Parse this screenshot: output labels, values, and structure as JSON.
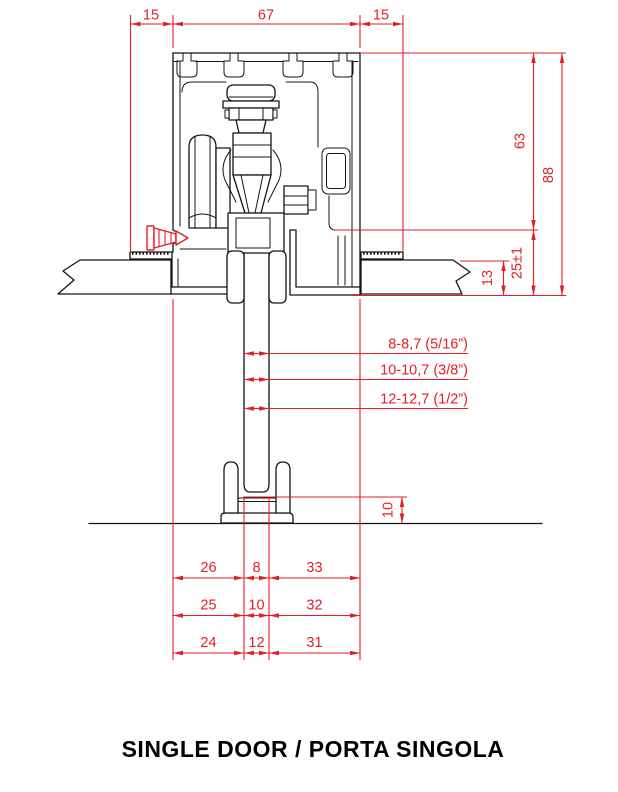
{
  "title": "SINGLE DOOR / PORTA SINGOLA",
  "colors": {
    "dimension_red": "#e31e24",
    "drawing_black": "#141414"
  },
  "dims": {
    "top_left_offset": "15",
    "top_track_width": "67",
    "top_right_offset": "15",
    "right_track_to_glass_top": "63",
    "right_total_height": "88",
    "right_glass_to_ceiling": "25±1",
    "right_ceiling_thickness": "13",
    "glass_rows": [
      "8-8,7 (5/16”)",
      "10-10,7 (3/8”)",
      "12-12,7 (1/2”)"
    ],
    "floor_guide_height": "10",
    "bottom_rows": [
      {
        "left": "26",
        "mid": "8",
        "right": "33"
      },
      {
        "left": "25",
        "mid": "10",
        "right": "32"
      },
      {
        "left": "24",
        "mid": "12",
        "right": "31"
      }
    ]
  }
}
